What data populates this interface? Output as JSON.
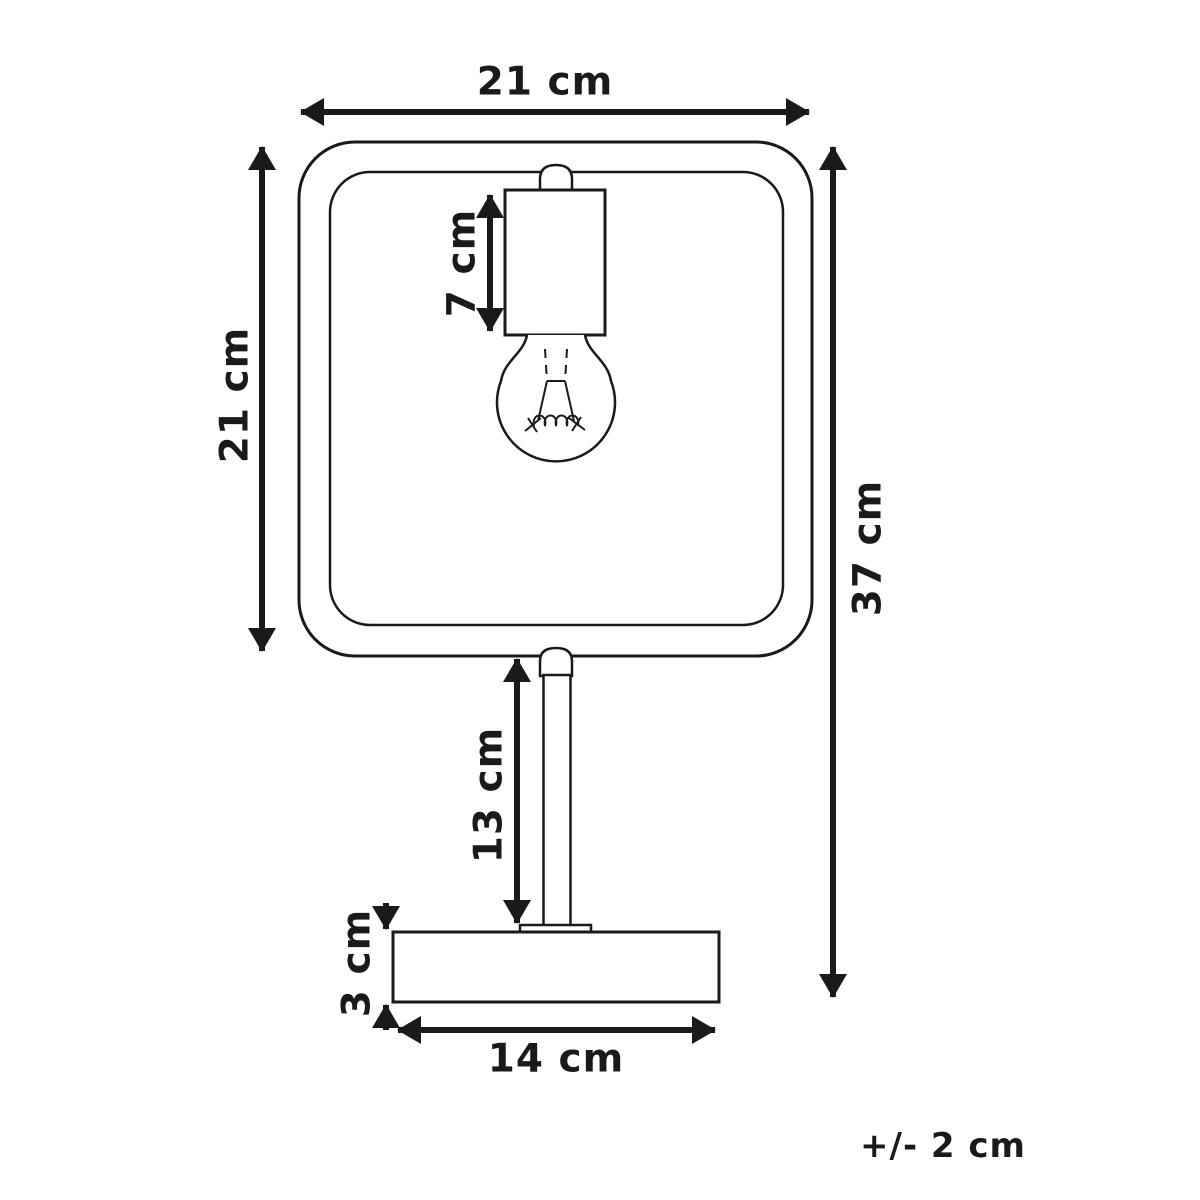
{
  "page": {
    "background": "#ffffff",
    "line_color": "#1a1a1a"
  },
  "diagram": {
    "kind": "product-dimension-drawing",
    "tolerance_note": "+/- 2 cm",
    "dimensions": [
      {
        "id": "frame-width",
        "label": "21 cm",
        "value": 21,
        "unit": "cm",
        "orientation": "horizontal"
      },
      {
        "id": "frame-height",
        "label": "21 cm",
        "value": 21,
        "unit": "cm",
        "orientation": "vertical"
      },
      {
        "id": "socket-height",
        "label": "7 cm",
        "value": 7,
        "unit": "cm",
        "orientation": "vertical"
      },
      {
        "id": "total-height",
        "label": "37 cm",
        "value": 37,
        "unit": "cm",
        "orientation": "vertical"
      },
      {
        "id": "stem-height",
        "label": "13 cm",
        "value": 13,
        "unit": "cm",
        "orientation": "vertical"
      },
      {
        "id": "base-height",
        "label": "3 cm",
        "value": 3,
        "unit": "cm",
        "orientation": "vertical"
      },
      {
        "id": "base-width",
        "label": "14 cm",
        "value": 14,
        "unit": "cm",
        "orientation": "horizontal"
      }
    ]
  }
}
